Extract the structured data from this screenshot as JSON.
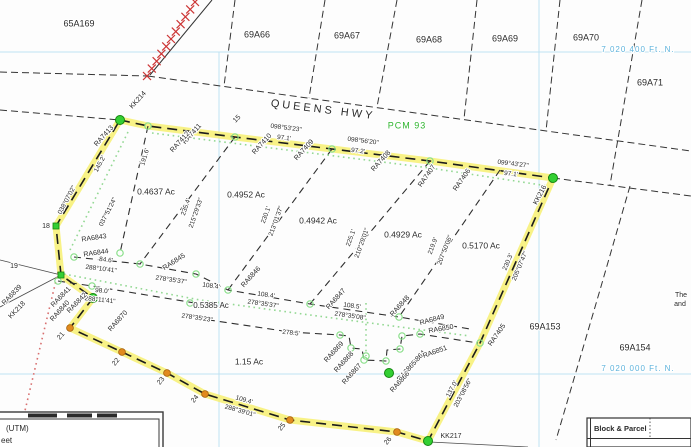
{
  "canvas": {
    "w": 691,
    "h": 447,
    "bg": "#fdfdfd"
  },
  "colors": {
    "text": "#2a2a2a",
    "grid_line": "#bfe2f2",
    "grid_text": "#5fb3dc",
    "pcm_green": "#2fb52f",
    "highlight_yellow": "#f6ef68",
    "marker_green": "#33cf33",
    "marker_green_edge": "#13860f",
    "circle_green": "#8adf8a",
    "orange": "#e18a1e",
    "orange_edge": "#a35f0c",
    "rail_red": "#cc3535",
    "dot_red": "#d87070",
    "dot_green": "#93d893",
    "line_dark": "#343434"
  },
  "lines": [
    {
      "n": "grid-northing-7020400",
      "k": "grid",
      "p": [
        [
          0,
          52
        ],
        [
          691,
          52
        ]
      ]
    },
    {
      "n": "grid-northing-7020000",
      "k": "grid",
      "p": [
        [
          0,
          374
        ],
        [
          691,
          374
        ]
      ]
    },
    {
      "n": "grid-easting-west",
      "k": "grid",
      "p": [
        [
          219,
          52
        ],
        [
          219,
          447
        ]
      ]
    },
    {
      "n": "grid-easting-east",
      "k": "grid",
      "p": [
        [
          539,
          0
        ],
        [
          539,
          447
        ]
      ]
    },
    {
      "n": "queens-hwy-north-edge-west",
      "k": "road",
      "p": [
        [
          0,
          72
        ],
        [
          148,
          76
        ]
      ]
    },
    {
      "n": "queens-hwy-north-edge",
      "k": "road",
      "p": [
        [
          148,
          76
        ],
        [
          691,
          151
        ]
      ]
    },
    {
      "n": "queens-hwy-south-edge-west",
      "k": "road",
      "p": [
        [
          0,
          110
        ],
        [
          120,
          120
        ]
      ]
    },
    {
      "n": "road-edge-east-of-kk216",
      "k": "road",
      "p": [
        [
          553,
          178
        ],
        [
          691,
          196
        ]
      ]
    },
    {
      "n": "block-65a169-69a66-line",
      "k": "road",
      "p": [
        [
          235,
          0
        ],
        [
          224,
          86
        ]
      ]
    },
    {
      "n": "block-69a66-67-line",
      "k": "road",
      "p": [
        [
          325,
          0
        ],
        [
          309,
          98
        ]
      ]
    },
    {
      "n": "block-69a67-68-line",
      "k": "road",
      "p": [
        [
          397,
          0
        ],
        [
          377,
          107
        ]
      ]
    },
    {
      "n": "block-69a68-69-line",
      "k": "road",
      "p": [
        [
          477,
          0
        ],
        [
          464,
          119
        ]
      ]
    },
    {
      "n": "block-69a69-70-line",
      "k": "road",
      "p": [
        [
          560,
          0
        ],
        [
          546,
          131
        ]
      ]
    },
    {
      "n": "block-69a70-71-line",
      "k": "road",
      "p": [
        [
          642,
          0
        ],
        [
          610,
          185
        ]
      ]
    },
    {
      "n": "block-69a153-154-line",
      "k": "road",
      "p": [
        [
          630,
          186
        ],
        [
          600,
          290
        ],
        [
          556,
          440
        ]
      ]
    },
    {
      "n": "railway-line",
      "k": "rail",
      "p": [
        [
          212,
          0
        ],
        [
          150,
          75
        ]
      ]
    },
    {
      "n": "tie-line-west",
      "k": "thin",
      "p": [
        [
          0,
          260
        ],
        [
          61,
          275
        ]
      ]
    },
    {
      "n": "tie-line-southwest",
      "k": "thin",
      "p": [
        [
          61,
          275
        ],
        [
          0,
          307
        ]
      ]
    },
    {
      "n": "tie-line-kk217",
      "k": "thin",
      "p": [
        [
          430,
          442
        ],
        [
          528,
          447
        ]
      ]
    },
    {
      "n": "subdivision-boundary",
      "k": "boundary",
      "p": [
        [
          120,
          120
        ],
        [
          148,
          126
        ],
        [
          235,
          137
        ],
        [
          332,
          149
        ],
        [
          430,
          161
        ],
        [
          553,
          178
        ],
        [
          480,
          343
        ],
        [
          428,
          441
        ],
        [
          397,
          432
        ],
        [
          290,
          420
        ],
        [
          205,
          394
        ],
        [
          167,
          373
        ],
        [
          122,
          352
        ],
        [
          70,
          328
        ],
        [
          93,
          298
        ],
        [
          61,
          275
        ],
        [
          56,
          226
        ],
        [
          120,
          120
        ]
      ]
    },
    {
      "n": "lot-line-191",
      "k": "inner",
      "p": [
        [
          148,
          126
        ],
        [
          120,
          253
        ]
      ]
    },
    {
      "n": "lot-line-235",
      "k": "inner",
      "p": [
        [
          235,
          137
        ],
        [
          140,
          264
        ]
      ]
    },
    {
      "n": "lot-line-230",
      "k": "inner",
      "p": [
        [
          332,
          149
        ],
        [
          228,
          290
        ]
      ]
    },
    {
      "n": "lot-line-225",
      "k": "inner",
      "p": [
        [
          430,
          161
        ],
        [
          310,
          304
        ]
      ]
    },
    {
      "n": "lot-line-219",
      "k": "inner",
      "p": [
        [
          500,
          170
        ],
        [
          399,
          317
        ]
      ]
    },
    {
      "n": "lot-line-south-of-upper-lots",
      "k": "inner",
      "p": [
        [
          74,
          257
        ],
        [
          140,
          264
        ],
        [
          196,
          274
        ],
        [
          228,
          290
        ],
        [
          310,
          304
        ],
        [
          399,
          317
        ],
        [
          470,
          329
        ]
      ]
    },
    {
      "n": "lot-line-98",
      "k": "inner",
      "p": [
        [
          58,
          281
        ],
        [
          92,
          286
        ],
        [
          207,
          305
        ]
      ]
    },
    {
      "n": "lot-line-strip-south-with-notch",
      "k": "inner",
      "p": [
        [
          196,
          318
        ],
        [
          290,
          332
        ],
        [
          340,
          335
        ],
        [
          349,
          336
        ],
        [
          351,
          348
        ],
        [
          362,
          349
        ],
        [
          364,
          360
        ],
        [
          386,
          361
        ],
        [
          387,
          350
        ],
        [
          400,
          349
        ],
        [
          402,
          336
        ],
        [
          420,
          334
        ],
        [
          478,
          343
        ]
      ]
    },
    {
      "n": "setback-dotted-left",
      "k": "dotg",
      "p": [
        [
          128,
          132
        ],
        [
          70,
          250
        ]
      ]
    },
    {
      "n": "setback-dotted-middle",
      "k": "dotg",
      "p": [
        [
          64,
          274
        ],
        [
          200,
          300
        ],
        [
          310,
          315
        ],
        [
          400,
          327
        ],
        [
          470,
          336
        ]
      ]
    },
    {
      "n": "setback-dotted-top",
      "k": "dotg",
      "p": [
        [
          152,
          133
        ],
        [
          430,
          168
        ],
        [
          548,
          186
        ]
      ]
    },
    {
      "n": "setback-dotted-notch",
      "k": "dotg",
      "p": [
        [
          366,
          303
        ],
        [
          366,
          356
        ]
      ]
    },
    {
      "n": "tie-dotted-red",
      "k": "dotr",
      "p": [
        [
          58,
          272
        ],
        [
          18,
          440
        ]
      ]
    }
  ],
  "hatch": {
    "x1": 195,
    "y1": 2,
    "x2": 147,
    "y2": 76,
    "n": 11,
    "size": 4
  },
  "markers": {
    "green_dots": [
      [
        120,
        120
      ],
      [
        553,
        178
      ],
      [
        428,
        441
      ],
      [
        93,
        298
      ],
      [
        389,
        373
      ]
    ],
    "green_squares": [
      [
        56,
        226
      ],
      [
        61,
        275
      ]
    ],
    "green_circles": [
      [
        148,
        126
      ],
      [
        235,
        137
      ],
      [
        332,
        149
      ],
      [
        430,
        161
      ],
      [
        74,
        257
      ],
      [
        140,
        264
      ],
      [
        196,
        274
      ],
      [
        228,
        290
      ],
      [
        310,
        304
      ],
      [
        399,
        317
      ],
      [
        58,
        281
      ],
      [
        92,
        286
      ],
      [
        190,
        303
      ],
      [
        480,
        343
      ],
      [
        120,
        253
      ],
      [
        340,
        335
      ],
      [
        351,
        348
      ],
      [
        364,
        360
      ],
      [
        386,
        361
      ],
      [
        400,
        349
      ],
      [
        402,
        336
      ],
      [
        420,
        334
      ],
      [
        366,
        356
      ]
    ],
    "orange_dots": [
      [
        70,
        328
      ],
      [
        122,
        352
      ],
      [
        167,
        373
      ],
      [
        205,
        394
      ],
      [
        290,
        420
      ],
      [
        397,
        432
      ]
    ]
  },
  "labels": [
    {
      "t": "65A169",
      "x": 79,
      "y": 24,
      "s": 9
    },
    {
      "t": "69A66",
      "x": 257,
      "y": 35,
      "s": 9
    },
    {
      "t": "69A67",
      "x": 347,
      "y": 36,
      "s": 9
    },
    {
      "t": "69A68",
      "x": 429,
      "y": 40,
      "s": 9
    },
    {
      "t": "69A69",
      "x": 505,
      "y": 39,
      "s": 9
    },
    {
      "t": "69A70",
      "x": 586,
      "y": 38,
      "s": 9
    },
    {
      "t": "69A71",
      "x": 650,
      "y": 83,
      "s": 9
    },
    {
      "t": "69A153",
      "x": 545,
      "y": 327,
      "s": 9
    },
    {
      "t": "69A154",
      "x": 635,
      "y": 348,
      "s": 9
    },
    {
      "t": "7 020 400 Ft. N.",
      "x": 638,
      "y": 50,
      "s": 8,
      "c": "grid_text",
      "ls": 1
    },
    {
      "t": "7 020 000 Ft. N.",
      "x": 638,
      "y": 369,
      "s": 8,
      "c": "grid_text",
      "ls": 1
    },
    {
      "t": "QUEENS  HWY",
      "x": 323,
      "y": 110,
      "s": 11,
      "r": 7,
      "ls": 3
    },
    {
      "t": "PCM 93",
      "x": 407,
      "y": 126,
      "s": 9,
      "c": "pcm_green",
      "ls": 1
    },
    {
      "t": "098°53'23\"",
      "x": 286,
      "y": 128,
      "r": 7,
      "s": 6.5
    },
    {
      "t": "97.1'",
      "x": 284,
      "y": 138,
      "r": 7,
      "s": 6.5
    },
    {
      "t": "098°56'20\"",
      "x": 363,
      "y": 141,
      "r": 7,
      "s": 6.5
    },
    {
      "t": "97.2'",
      "x": 358,
      "y": 151,
      "r": 7,
      "s": 6.5
    },
    {
      "t": "099°43'27\"",
      "x": 513,
      "y": 164,
      "r": 7,
      "s": 6.5
    },
    {
      "t": "97.1'",
      "x": 511,
      "y": 174,
      "r": 7,
      "s": 6.5
    },
    {
      "t": "038°07'02\"",
      "x": 67,
      "y": 200,
      "r": -62,
      "s": 6.5
    },
    {
      "t": "145.2'",
      "x": 100,
      "y": 164,
      "r": -62,
      "s": 6.5
    },
    {
      "t": "037°51'24\"",
      "x": 108,
      "y": 212,
      "r": -63,
      "s": 6.5
    },
    {
      "t": "191.6'",
      "x": 145,
      "y": 157,
      "r": -73,
      "s": 6.5
    },
    {
      "t": "235.4'",
      "x": 186,
      "y": 207,
      "r": -71,
      "s": 6.5
    },
    {
      "t": "215°29'33\"",
      "x": 196,
      "y": 213,
      "r": -71,
      "s": 6.5
    },
    {
      "t": "230.1'",
      "x": 266,
      "y": 215,
      "r": -70,
      "s": 6.5
    },
    {
      "t": "213°01'37\"",
      "x": 276,
      "y": 221,
      "r": -70,
      "s": 6.5
    },
    {
      "t": "225.1'",
      "x": 351,
      "y": 238,
      "r": -70,
      "s": 6.5
    },
    {
      "t": "210°29'01\"",
      "x": 362,
      "y": 243,
      "r": -70,
      "s": 6.5
    },
    {
      "t": "219.9'",
      "x": 433,
      "y": 246,
      "r": -69,
      "s": 6.5
    },
    {
      "t": "207°50'06\"",
      "x": 445,
      "y": 250,
      "r": -69,
      "s": 6.5
    },
    {
      "t": "230.3'",
      "x": 508,
      "y": 262,
      "r": -67,
      "s": 6.5
    },
    {
      "t": "205°07'47\"",
      "x": 520,
      "y": 266,
      "r": -67,
      "s": 6.5
    },
    {
      "t": "137.0'",
      "x": 452,
      "y": 389,
      "r": -62,
      "s": 6.5
    },
    {
      "t": "203°08'56\"",
      "x": 463,
      "y": 393,
      "r": -62,
      "s": 6.5
    },
    {
      "t": "84.6'",
      "x": 106,
      "y": 260,
      "r": 7,
      "s": 6.5
    },
    {
      "t": "288°10'41\"",
      "x": 101,
      "y": 269,
      "r": 7,
      "s": 6.5
    },
    {
      "t": "98.0'",
      "x": 102,
      "y": 291,
      "r": 6,
      "s": 6.5
    },
    {
      "t": "288°11'41\"",
      "x": 100,
      "y": 300,
      "r": 6,
      "s": 6.5
    },
    {
      "t": "108.4'",
      "x": 211,
      "y": 286,
      "r": 8,
      "s": 6.5
    },
    {
      "t": "278°35'37\"",
      "x": 171,
      "y": 280,
      "r": 8,
      "s": 6.5
    },
    {
      "t": "108.4'",
      "x": 266,
      "y": 295,
      "r": 8,
      "s": 6.5
    },
    {
      "t": "278°35'37\"",
      "x": 263,
      "y": 304,
      "r": 8,
      "s": 6.5
    },
    {
      "t": "108.5'",
      "x": 352,
      "y": 306,
      "r": 8,
      "s": 6.5
    },
    {
      "t": "278°35'08\"",
      "x": 350,
      "y": 316,
      "r": 8,
      "s": 6.5
    },
    {
      "t": "278°35'23\"",
      "x": 197,
      "y": 318,
      "r": 8,
      "s": 6.5
    },
    {
      "t": "278.5'",
      "x": 291,
      "y": 333,
      "r": 6,
      "s": 6.5
    },
    {
      "t": "109.4'",
      "x": 244,
      "y": 400,
      "r": 16,
      "s": 6.5
    },
    {
      "t": "288°39'01\"",
      "x": 240,
      "y": 411,
      "r": 16,
      "s": 6.5
    },
    {
      "t": "RA7413",
      "x": 104,
      "y": 136,
      "r": -48
    },
    {
      "t": "RA7411",
      "x": 192,
      "y": 134,
      "r": -48
    },
    {
      "t": "RA7412",
      "x": 180,
      "y": 142,
      "r": -48
    },
    {
      "t": "RA7410",
      "x": 262,
      "y": 144,
      "r": -48
    },
    {
      "t": "RA7409",
      "x": 304,
      "y": 150,
      "r": -48
    },
    {
      "t": "RA7408",
      "x": 381,
      "y": 161,
      "r": -48
    },
    {
      "t": "RA7407",
      "x": 427,
      "y": 176,
      "r": -55
    },
    {
      "t": "RA7406",
      "x": 462,
      "y": 180,
      "r": -55
    },
    {
      "t": "RA7405",
      "x": 497,
      "y": 335,
      "r": -55
    },
    {
      "t": "KK214",
      "x": 138,
      "y": 100,
      "r": -48
    },
    {
      "t": "KK216",
      "x": 540,
      "y": 195,
      "r": -62
    },
    {
      "t": "KK217",
      "x": 451,
      "y": 436
    },
    {
      "t": "KK218",
      "x": 17,
      "y": 310,
      "r": -46
    },
    {
      "t": "RA6839",
      "x": 12,
      "y": 295,
      "r": -46
    },
    {
      "t": "RA6843",
      "x": 94,
      "y": 238,
      "r": -8
    },
    {
      "t": "RA6844",
      "x": 96,
      "y": 253,
      "r": -8
    },
    {
      "t": "RA6845",
      "x": 174,
      "y": 262,
      "r": -33
    },
    {
      "t": "RA6846",
      "x": 251,
      "y": 277,
      "r": -48
    },
    {
      "t": "RA6847",
      "x": 336,
      "y": 299,
      "r": -48
    },
    {
      "t": "RA6848",
      "x": 400,
      "y": 306,
      "r": -48
    },
    {
      "t": "RA6841",
      "x": 61,
      "y": 297,
      "r": -46
    },
    {
      "t": "RA6842",
      "x": 77,
      "y": 303,
      "r": -46
    },
    {
      "t": "RA6840",
      "x": 60,
      "y": 311,
      "r": -48
    },
    {
      "t": "RA6870",
      "x": 118,
      "y": 321,
      "r": -48
    },
    {
      "t": "RA6869",
      "x": 334,
      "y": 352,
      "r": -48
    },
    {
      "t": "RA6868",
      "x": 344,
      "y": 362,
      "r": -48
    },
    {
      "t": "RA6867",
      "x": 352,
      "y": 374,
      "r": -48
    },
    {
      "t": "RA6864",
      "x": 416,
      "y": 361,
      "r": -48
    },
    {
      "t": "RA6865",
      "x": 407,
      "y": 371,
      "r": -48
    },
    {
      "t": "RA6866",
      "x": 400,
      "y": 382,
      "r": -48
    },
    {
      "t": "RA6849",
      "x": 432,
      "y": 320,
      "r": -15
    },
    {
      "t": "RA6850",
      "x": 441,
      "y": 329,
      "r": -10
    },
    {
      "t": "RA6851",
      "x": 435,
      "y": 352,
      "r": -20
    },
    {
      "t": "15",
      "x": 237,
      "y": 119,
      "r": -45
    },
    {
      "t": "18",
      "x": 46,
      "y": 226
    },
    {
      "t": "19",
      "x": 14,
      "y": 266
    },
    {
      "t": "21",
      "x": 61,
      "y": 336,
      "r": -50
    },
    {
      "t": "22",
      "x": 116,
      "y": 362,
      "r": -50
    },
    {
      "t": "23",
      "x": 161,
      "y": 381,
      "r": -50
    },
    {
      "t": "24",
      "x": 195,
      "y": 399,
      "r": -50
    },
    {
      "t": "25",
      "x": 282,
      "y": 427,
      "r": -50
    },
    {
      "t": "26",
      "x": 388,
      "y": 441,
      "r": -50
    },
    {
      "t": "0.4637 Ac",
      "x": 156,
      "y": 192,
      "s": 8.5
    },
    {
      "t": "0.4952 Ac",
      "x": 246,
      "y": 195,
      "s": 8.5
    },
    {
      "t": "0.4942 Ac",
      "x": 318,
      "y": 221,
      "s": 8.5
    },
    {
      "t": "0.4929 Ac",
      "x": 403,
      "y": 235,
      "s": 8.5
    },
    {
      "t": "0.5170 Ac",
      "x": 481,
      "y": 246,
      "s": 8.5
    },
    {
      "t": "0.5385 Ac",
      "x": 211,
      "y": 306,
      "s": 8
    },
    {
      "t": "1.15 Ac",
      "x": 249,
      "y": 362,
      "s": 8.5
    },
    {
      "t": "The",
      "x": 681,
      "y": 295,
      "s": 7
    },
    {
      "t": "and",
      "x": 680,
      "y": 304,
      "s": 7
    }
  ],
  "scalebar": {
    "line1": "(UTM)",
    "line2": "eet"
  },
  "block_parcel": {
    "header": "Block & Parcel"
  }
}
